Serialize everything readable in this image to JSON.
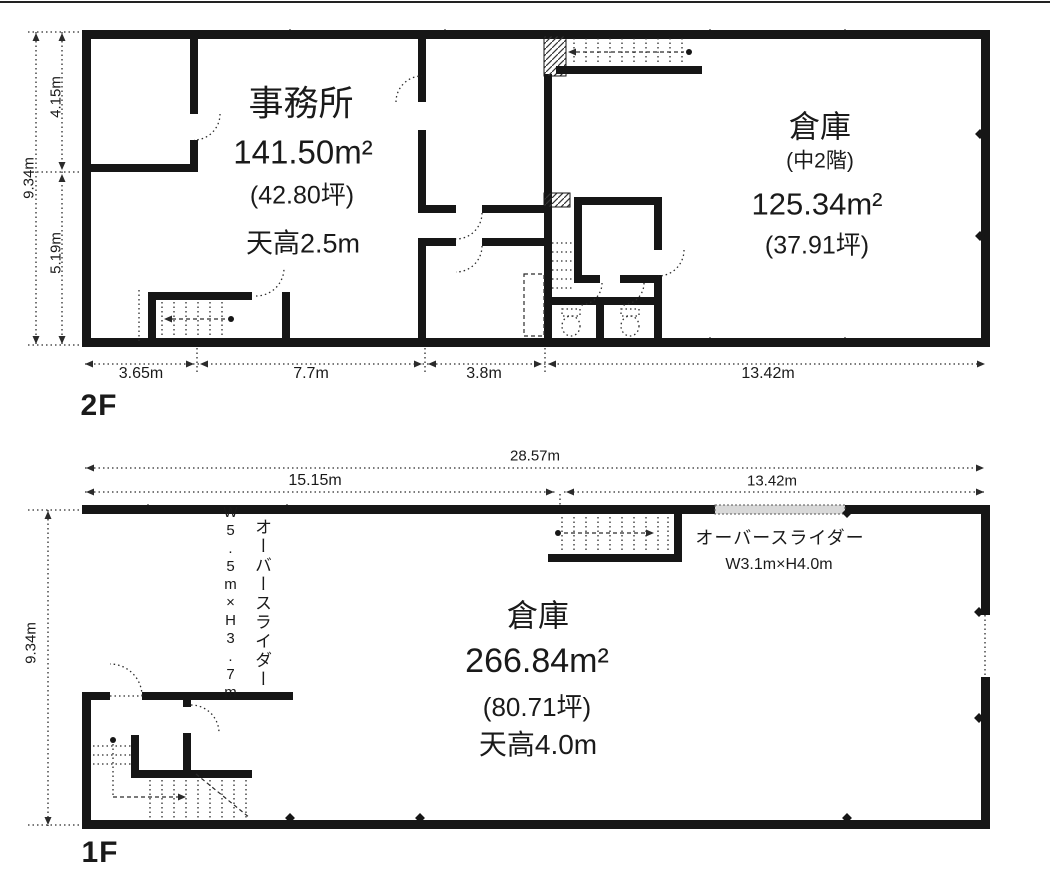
{
  "meta": {
    "ink_color": "#1a1a1a",
    "background_color": "#ffffff"
  },
  "floor2": {
    "floor_label": "2F",
    "office": {
      "name": "事務所",
      "area": "141.50m²",
      "tsubo": "(42.80坪)",
      "ceiling": "天高2.5m"
    },
    "warehouse": {
      "name": "倉庫",
      "note": "(中2階)",
      "area": "125.34m²",
      "tsubo": "(37.91坪)"
    },
    "dims": {
      "left_top": "4.15m",
      "left_total": "9.34m",
      "left_bottom": "5.19m",
      "bottom": [
        "3.65m",
        "7.7m",
        "3.8m",
        "13.42m"
      ]
    }
  },
  "floor1": {
    "floor_label": "1F",
    "warehouse": {
      "name": "倉庫",
      "area": "266.84m²",
      "tsubo": "(80.71坪)",
      "ceiling": "天高4.0m"
    },
    "overslider_left": {
      "name": "オーバースライダー",
      "size": "W5.5m×H3.7m"
    },
    "overslider_top": {
      "name": "オーバースライダー",
      "size": "W3.1m×H4.0m"
    },
    "dims": {
      "top_total": "28.57m",
      "top_left": "15.15m",
      "top_right": "13.42m",
      "left": "9.34m"
    }
  }
}
